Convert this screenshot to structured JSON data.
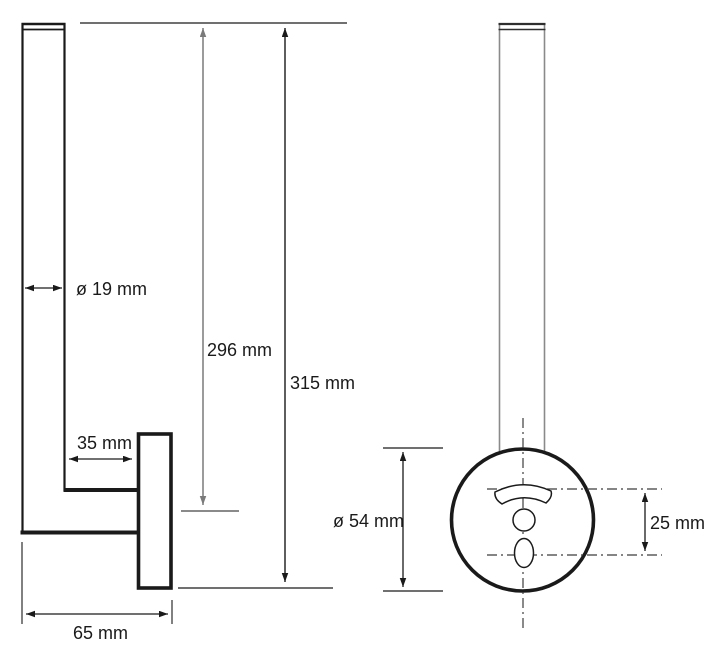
{
  "drawing": {
    "dimensions": {
      "rod_diameter": "ø 19 mm",
      "rod_height": "296 mm",
      "total_height": "315 mm",
      "arm_depth": "35 mm",
      "base_depth": "65 mm",
      "plate_diameter": "ø 54 mm",
      "hole_spacing": "25 mm"
    },
    "colors": {
      "primary_line": "#1a1a1a",
      "secondary_line": "#7a7a7a",
      "rod_front_line": "#8a8a8a",
      "background": "#ffffff"
    }
  }
}
